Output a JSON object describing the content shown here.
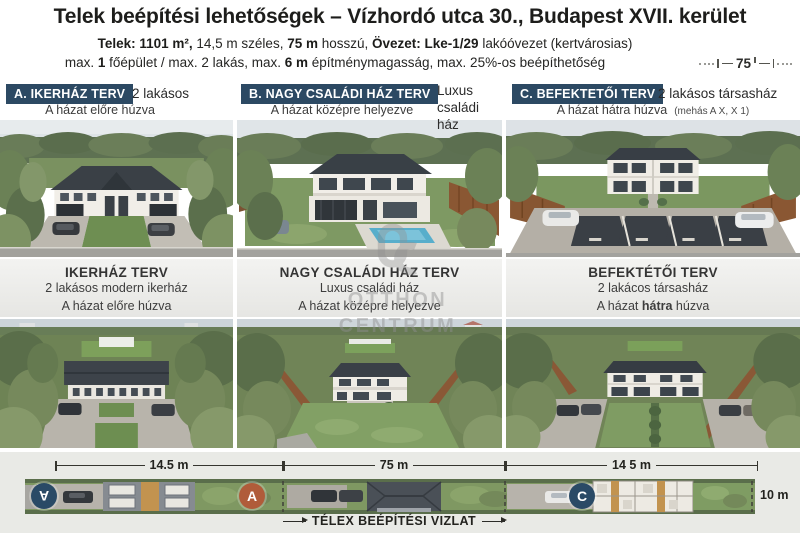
{
  "header": {
    "title": "Telek beépítési lehetőségek – Vízhordó utca 30., Budapest XVII. kerület",
    "spec1": {
      "b1": "Telek: 1101 m²,",
      "r1": " 14,5 m széles, ",
      "b2": "75 m",
      "r2": " hosszú, ",
      "b3": "Övezet: Lke-1/29",
      "r3": " lakóóvezet (kertvárosias)"
    },
    "spec2": {
      "r1": "max. ",
      "b1": "1",
      "r2": " főépület / max. 2 lakás, max. ",
      "b2": "6 m",
      "r3": " építménymagasság, max. 25%-os beépíthetőség"
    },
    "dim_right": "75"
  },
  "columns": [
    {
      "badge": "A. IKERHÁZ TERV",
      "tagline": "2 lakásos",
      "subline": "A házat előre húzva",
      "note": "",
      "mid_title": "IKERHÁZ TERV",
      "mid_line1": "2 lakásos modern ikerház",
      "mid_line2_pre": "A házat előre húzva",
      "mid_line2_bold": "",
      "mid_line2_post": ""
    },
    {
      "badge": "B. NAGY CSALÁDI HÁZ TERV",
      "tagline": "Luxus családi ház",
      "subline": "A házat középre helyezve",
      "note": "",
      "mid_title": "NAGY CSALÁDI HÁZ TERV",
      "mid_line1": "Luxus családi ház",
      "mid_line2_pre": "A házat középre helyezve",
      "mid_line2_bold": "",
      "mid_line2_post": ""
    },
    {
      "badge": "C. BEFEKTETŐI TERV",
      "tagline": "2 lakásos társasház",
      "subline": "A házat hátra húzva",
      "note": "(mehás A X, X 1)",
      "mid_title": "BEFEKTÉTŐI TERV",
      "mid_line1": "2 lakácos társasház",
      "mid_line2_pre": "A házat ",
      "mid_line2_bold": "hátra",
      "mid_line2_post": " húzva"
    }
  ],
  "watermark": {
    "line1": "OTTHON",
    "line2": "CENTRUM"
  },
  "siteplan": {
    "dim_left": "14.5 m",
    "dim_mid": "75 m",
    "dim_right": "14 5 m",
    "dim_depth": "10 m",
    "badge_left": "A",
    "badge_mid": "A",
    "badge_right": "C",
    "caption": "TÉLEX BEÉPÍTÉSI VIZLAT"
  },
  "colors": {
    "navy": "#2c4963",
    "badge_blue": "#2a4a66",
    "badge_orange": "#b05c3a",
    "panel_gray": "#ebebe8"
  }
}
